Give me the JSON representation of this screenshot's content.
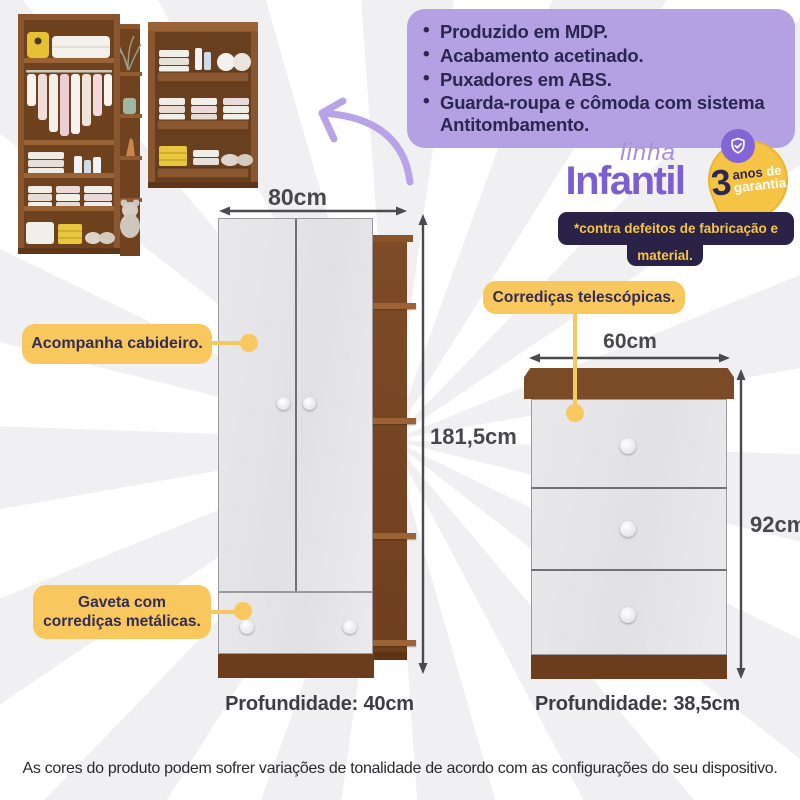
{
  "features": {
    "items": [
      "Produzido em MDP.",
      "Acabamento acetinado.",
      "Puxadores em ABS.",
      "Guarda-roupa e cômoda com sistema Antitombamento."
    ]
  },
  "brand": {
    "line_label": "linha",
    "name": "Infantil"
  },
  "badge": {
    "number": "3",
    "word_anos": "anos",
    "word_de": "de",
    "word_garantia": "garantia"
  },
  "warranty_note": {
    "line1": "*contra defeitos de fabricação e",
    "line2": "material."
  },
  "callouts": {
    "cabideiro": "Acompanha cabideiro.",
    "telescopicas": "Corrediças telescópicas.",
    "gaveta": "Gaveta com corrediças metálicas."
  },
  "wardrobe": {
    "width": "80cm",
    "height": "181,5cm",
    "depth": "Profundidade: 40cm"
  },
  "dresser": {
    "width": "60cm",
    "height": "92cm",
    "depth": "Profundidade: 38,5cm"
  },
  "footer": {
    "disclaimer": "As cores do produto podem sofrer variações de tonalidade de acordo com as configurações do seu dispositivo."
  },
  "colors": {
    "accent_yellow": "#f8c85f",
    "features_purple": "#b4a1e4",
    "brand_purple": "#7b5ed2",
    "navy": "#2b2347",
    "badge_yellow": "#f6c444",
    "wood_brown": "#6e3f1f",
    "panel_gray": "#e7e7e9"
  }
}
